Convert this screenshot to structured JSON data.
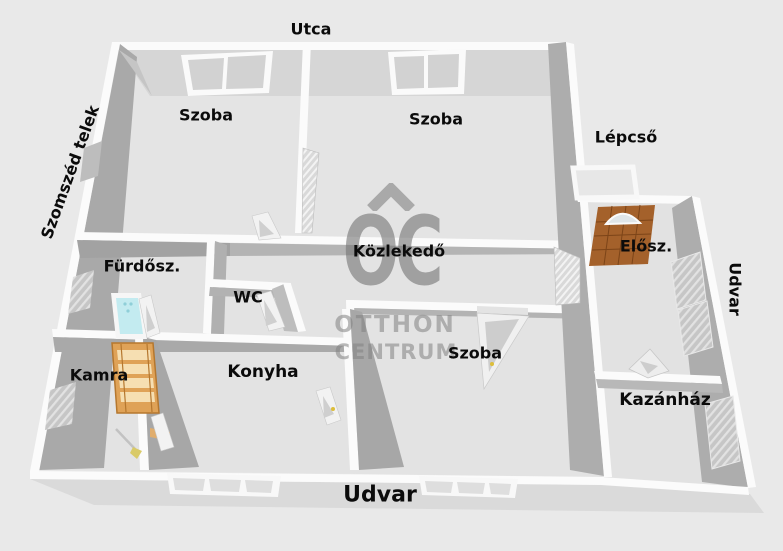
{
  "plan_title": "Lakás alaprajz",
  "outside_labels": {
    "street": "Utca",
    "neighbor_plot": "Szomszéd telek",
    "stairs": "Lépcső",
    "yard_right": "Udvar",
    "yard_bottom": "Udvar"
  },
  "rooms": [
    {
      "id": "szoba-1",
      "label": "Szoba"
    },
    {
      "id": "szoba-2",
      "label": "Szoba"
    },
    {
      "id": "furdoszoba",
      "label": "Fürdősz."
    },
    {
      "id": "wc",
      "label": "WC"
    },
    {
      "id": "kozlekedo",
      "label": "Közlekedő"
    },
    {
      "id": "eloszoba",
      "label": "Elősz."
    },
    {
      "id": "kamra",
      "label": "Kamra"
    },
    {
      "id": "konyha",
      "label": "Konyha"
    },
    {
      "id": "szoba-3",
      "label": "Szoba"
    },
    {
      "id": "kazanhaz",
      "label": "Kazánház"
    }
  ],
  "watermark": {
    "logo": "OC",
    "line1": "OTTHON",
    "line2": "CENTRUM"
  },
  "objects": {
    "bathtub": "bathtub",
    "pantry_rack": "wooden-shelf",
    "entry_doormat": "brown-doormat",
    "broom": "broom",
    "stairs_platform": "open-stairs"
  },
  "colors": {
    "background": "#e9e9e9",
    "floor": "#e3e3e3",
    "wall_top": "#fbfbfb",
    "wall_shadow": "#a9a9a9",
    "north_face": "#d6d6d6",
    "bathtub": "#c3ebf0",
    "wood_rack": "#dfa257",
    "doormat": "#a4612b",
    "watermark_gray": "#a7a7a7",
    "label_text": "#0b0b0b",
    "door_handle": "#ddbe3a"
  }
}
